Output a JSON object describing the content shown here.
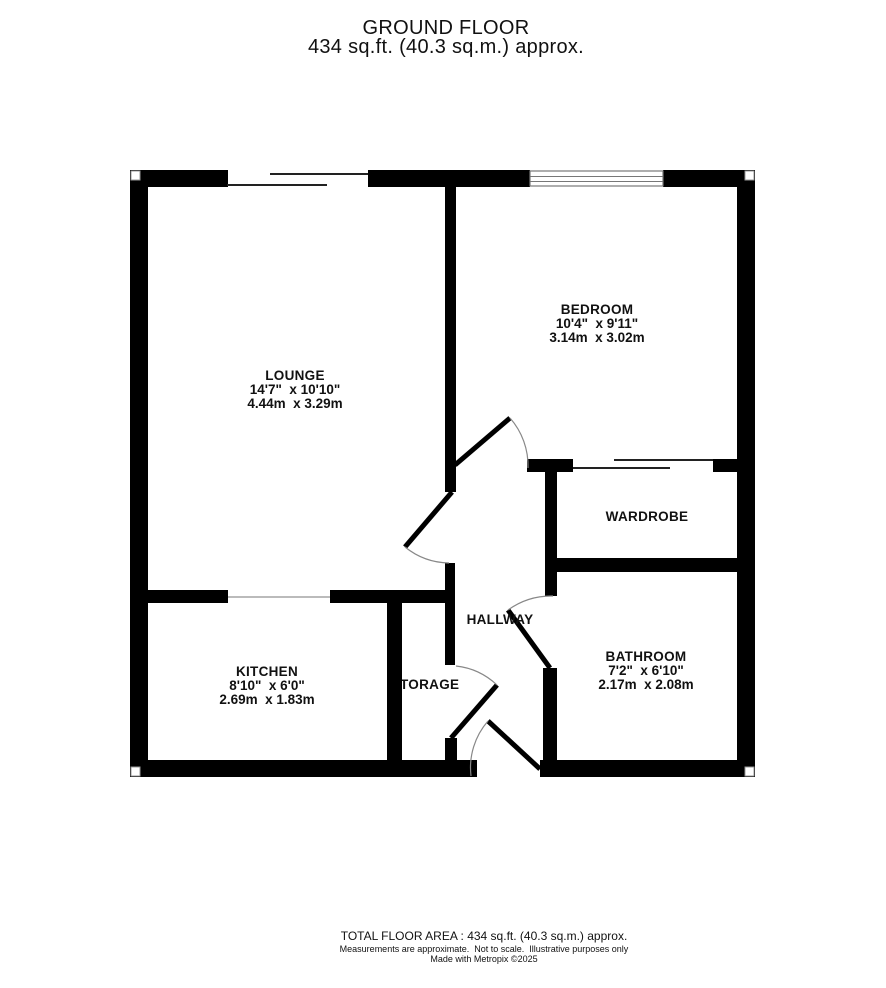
{
  "header": {
    "title": "GROUND FLOOR",
    "subtitle": "434 sq.ft. (40.3 sq.m.) approx."
  },
  "rooms": {
    "lounge": {
      "name": "LOUNGE",
      "imperial": "14'7\"  x 10'10\"",
      "metric": "4.44m  x 3.29m"
    },
    "bedroom": {
      "name": "BEDROOM",
      "imperial": "10'4\"  x 9'11\"",
      "metric": "3.14m  x 3.02m"
    },
    "wardrobe": {
      "name": "WARDROBE"
    },
    "hallway": {
      "name": "HALLWAY"
    },
    "kitchen": {
      "name": "KITCHEN",
      "imperial": "8'10\"  x 6'0\"",
      "metric": "2.69m  x 1.83m"
    },
    "storage": {
      "name": "STORAGE"
    },
    "bathroom": {
      "name": "BATHROOM",
      "imperial": "7'2\"  x 6'10\"",
      "metric": "2.17m  x 2.08m"
    }
  },
  "footer": {
    "total": "TOTAL FLOOR AREA : 434 sq.ft. (40.3 sq.m.) approx.",
    "disclaimer": "Measurements are approximate.  Not to scale.  Illustrative purposes only",
    "credit": "Made with Metropix ©2025"
  },
  "colors": {
    "wall": "#000000",
    "background": "#ffffff",
    "door_arc": "#888888"
  }
}
